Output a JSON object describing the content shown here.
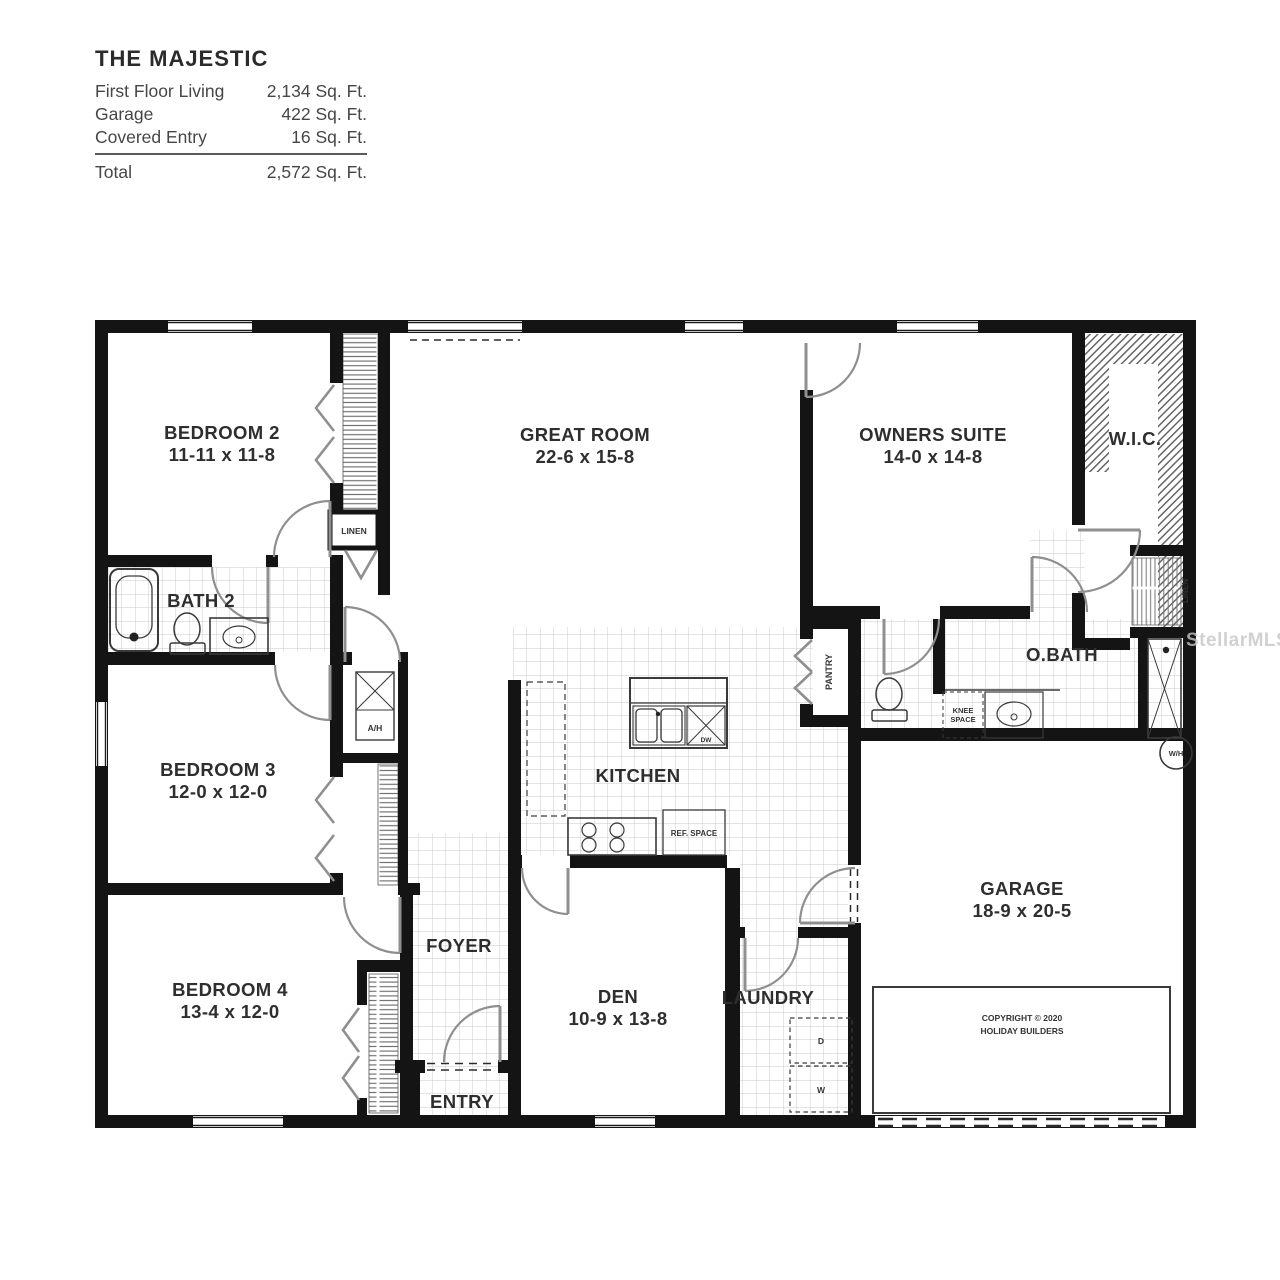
{
  "title_block": {
    "title": "THE MAJESTIC",
    "rows": [
      {
        "label": "First Floor Living",
        "value": "2,134 Sq. Ft."
      },
      {
        "label": "Garage",
        "value": "422 Sq. Ft."
      },
      {
        "label": "Covered Entry",
        "value": "16 Sq. Ft."
      }
    ],
    "total_label": "Total",
    "total_value": "2,572 Sq. Ft."
  },
  "rooms": {
    "bedroom2": {
      "name": "BEDROOM 2",
      "dims": "11-11 x 11-8"
    },
    "bedroom3": {
      "name": "BEDROOM 3",
      "dims": "12-0 x 12-0"
    },
    "bedroom4": {
      "name": "BEDROOM 4",
      "dims": "13-4 x 12-0"
    },
    "great_room": {
      "name": "GREAT ROOM",
      "dims": "22-6 x 15-8"
    },
    "owners_suite": {
      "name": "OWNERS SUITE",
      "dims": "14-0 x 14-8"
    },
    "den": {
      "name": "DEN",
      "dims": "10-9 x 13-8"
    },
    "garage": {
      "name": "GARAGE",
      "dims": "18-9 x 20-5"
    },
    "kitchen": {
      "name": "KITCHEN"
    },
    "bath2": {
      "name": "BATH 2"
    },
    "obath": {
      "name": "O.BATH"
    },
    "wic": {
      "name": "W.I.C."
    },
    "foyer": {
      "name": "FOYER"
    },
    "entry": {
      "name": "ENTRY"
    },
    "laundry": {
      "name": "LAUNDRY"
    }
  },
  "labels": {
    "linen": "LINEN",
    "linen_right": "LINEN",
    "pantry": "PANTRY",
    "ah": "A/H",
    "wh": "W/H",
    "knee_line1": "KNEE",
    "knee_line2": "SPACE",
    "ref_space": "REF. SPACE",
    "dw": "DW",
    "dryer": "D",
    "washer": "W"
  },
  "copyright": {
    "line1": "COPYRIGHT © 2020",
    "line2": "HOLIDAY BUILDERS"
  },
  "watermark": "StellarMLS",
  "colors": {
    "wall": "#141414",
    "door": "#8f8f8f",
    "tile": "#c9c9c9",
    "text": "#2e2e2e"
  }
}
